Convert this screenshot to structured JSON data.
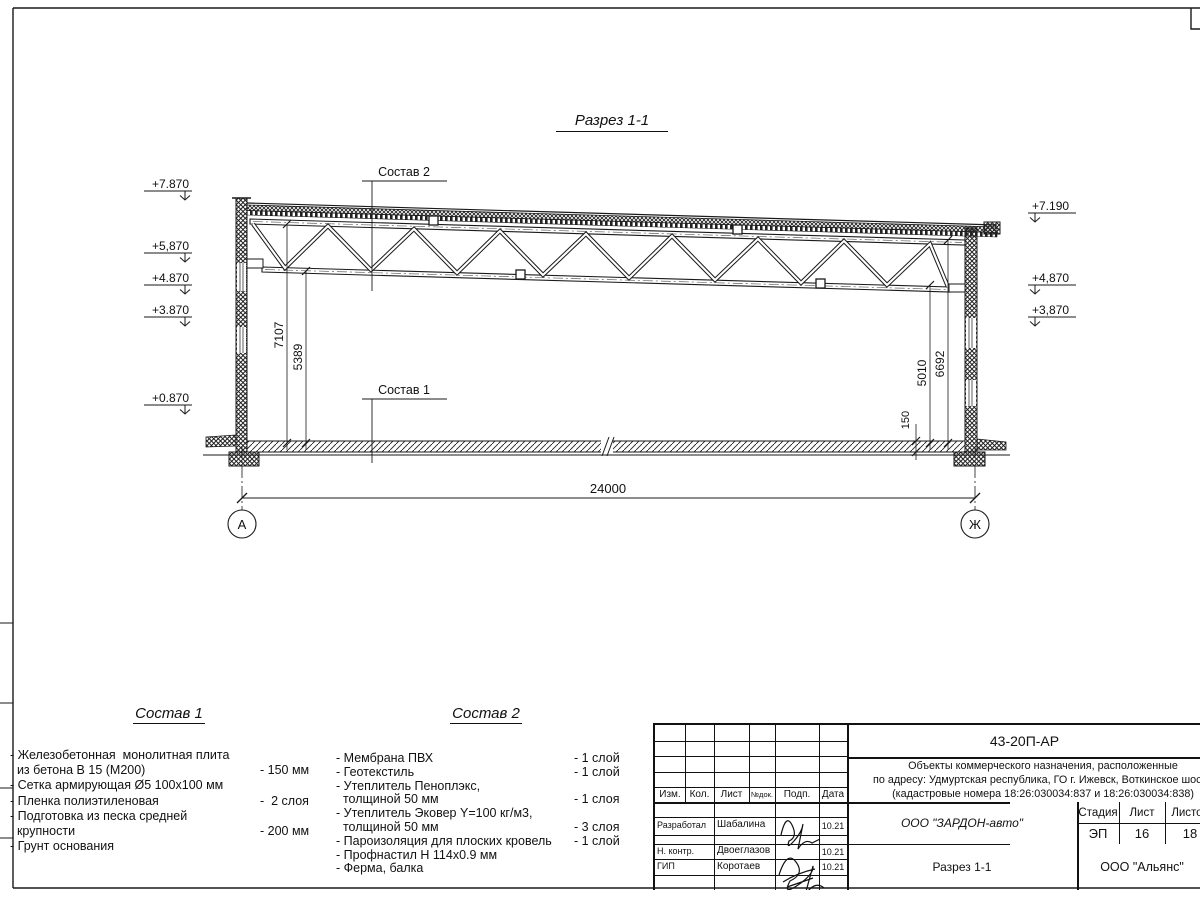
{
  "drawing": {
    "title": "Разрез 1-1",
    "leader_top": "Состав 2",
    "leader_bottom": "Состав 1",
    "span_dim": "24000",
    "axis_left": "А",
    "axis_right": "Ж",
    "dim_left_outer": "7107",
    "dim_left_inner": "5389",
    "dim_right_inner": "5010",
    "dim_right_outer": "6692",
    "dim_slab": "150",
    "elevations_left": [
      "+7.870",
      "+5,870",
      "+4.870",
      "+3.870",
      "+0.870"
    ],
    "elevations_right": [
      "+7.190",
      "+4,870",
      "+3,870"
    ]
  },
  "composition1": {
    "title": "Состав 1",
    "rows": [
      {
        "text": "- Железобетонная  монолитная плита",
        "value": ""
      },
      {
        "text": "  из бетона В 15 (М200)",
        "value": "- 150 мм"
      },
      {
        "text": "- Сетка армирующая Ø5 100х100 мм",
        "value": ""
      },
      {
        "text": "- Пленка полиэтиленовая",
        "value": "-  2 слоя"
      },
      {
        "text": "- Подготовка из песка средней",
        "value": ""
      },
      {
        "text": "  крупности",
        "value": "- 200 мм"
      },
      {
        "text": "- Грунт основания",
        "value": ""
      }
    ]
  },
  "composition2": {
    "title": "Состав 2",
    "rows": [
      {
        "text": "- Мембрана ПВХ",
        "value": "- 1 слой"
      },
      {
        "text": "- Геотекстиль",
        "value": "- 1 слой"
      },
      {
        "text": "- Утеплитель Пеноплэкс,",
        "value": ""
      },
      {
        "text": "  толщиной 50 мм",
        "value": "- 1 слоя"
      },
      {
        "text": "- Утеплитель Эковер Y=100 кг/м3,",
        "value": ""
      },
      {
        "text": "  толщиной 50 мм",
        "value": "- 3 слоя"
      },
      {
        "text": "- Пароизоляция для плоских кровель",
        "value": "- 1 слой"
      },
      {
        "text": "- Профнастил Н 114х0.9 мм",
        "value": ""
      },
      {
        "text": "- Ферма, балка",
        "value": ""
      }
    ]
  },
  "titleblock": {
    "doc_code": "43-20П-АР",
    "project_line1": "Объекты коммерческого назначения, расположенные",
    "project_line2": "по адресу: Удмуртская республика, ГО г. Ижевск, Воткинское шоссе",
    "project_line3": "(кадастровые номера 18:26:030034:837 и 18:26:030034:838)",
    "headers": {
      "izm": "Изм.",
      "kol": "Кол.",
      "list": "Лист",
      "ndok": "№док.",
      "podp": "Подп.",
      "data": "Дата",
      "stage": "Стадия",
      "sheet": "Лист",
      "sheets": "Листов"
    },
    "org": "ООО \"ЗАРДОН-авто\"",
    "stage_value": "ЭП",
    "sheet_value": "16",
    "sheets_value": "18",
    "drawing_title": "Разрез 1-1",
    "company": "ООО \"Альянс\"",
    "signers": [
      {
        "role": "Разработал",
        "name": "Шабалина",
        "date": "10.21"
      },
      {
        "role": "Н. контр.",
        "name": "Двоеглазов",
        "date": "10.21"
      },
      {
        "role": "ГИП",
        "name": "Коротаев",
        "date": "10.21"
      }
    ]
  }
}
